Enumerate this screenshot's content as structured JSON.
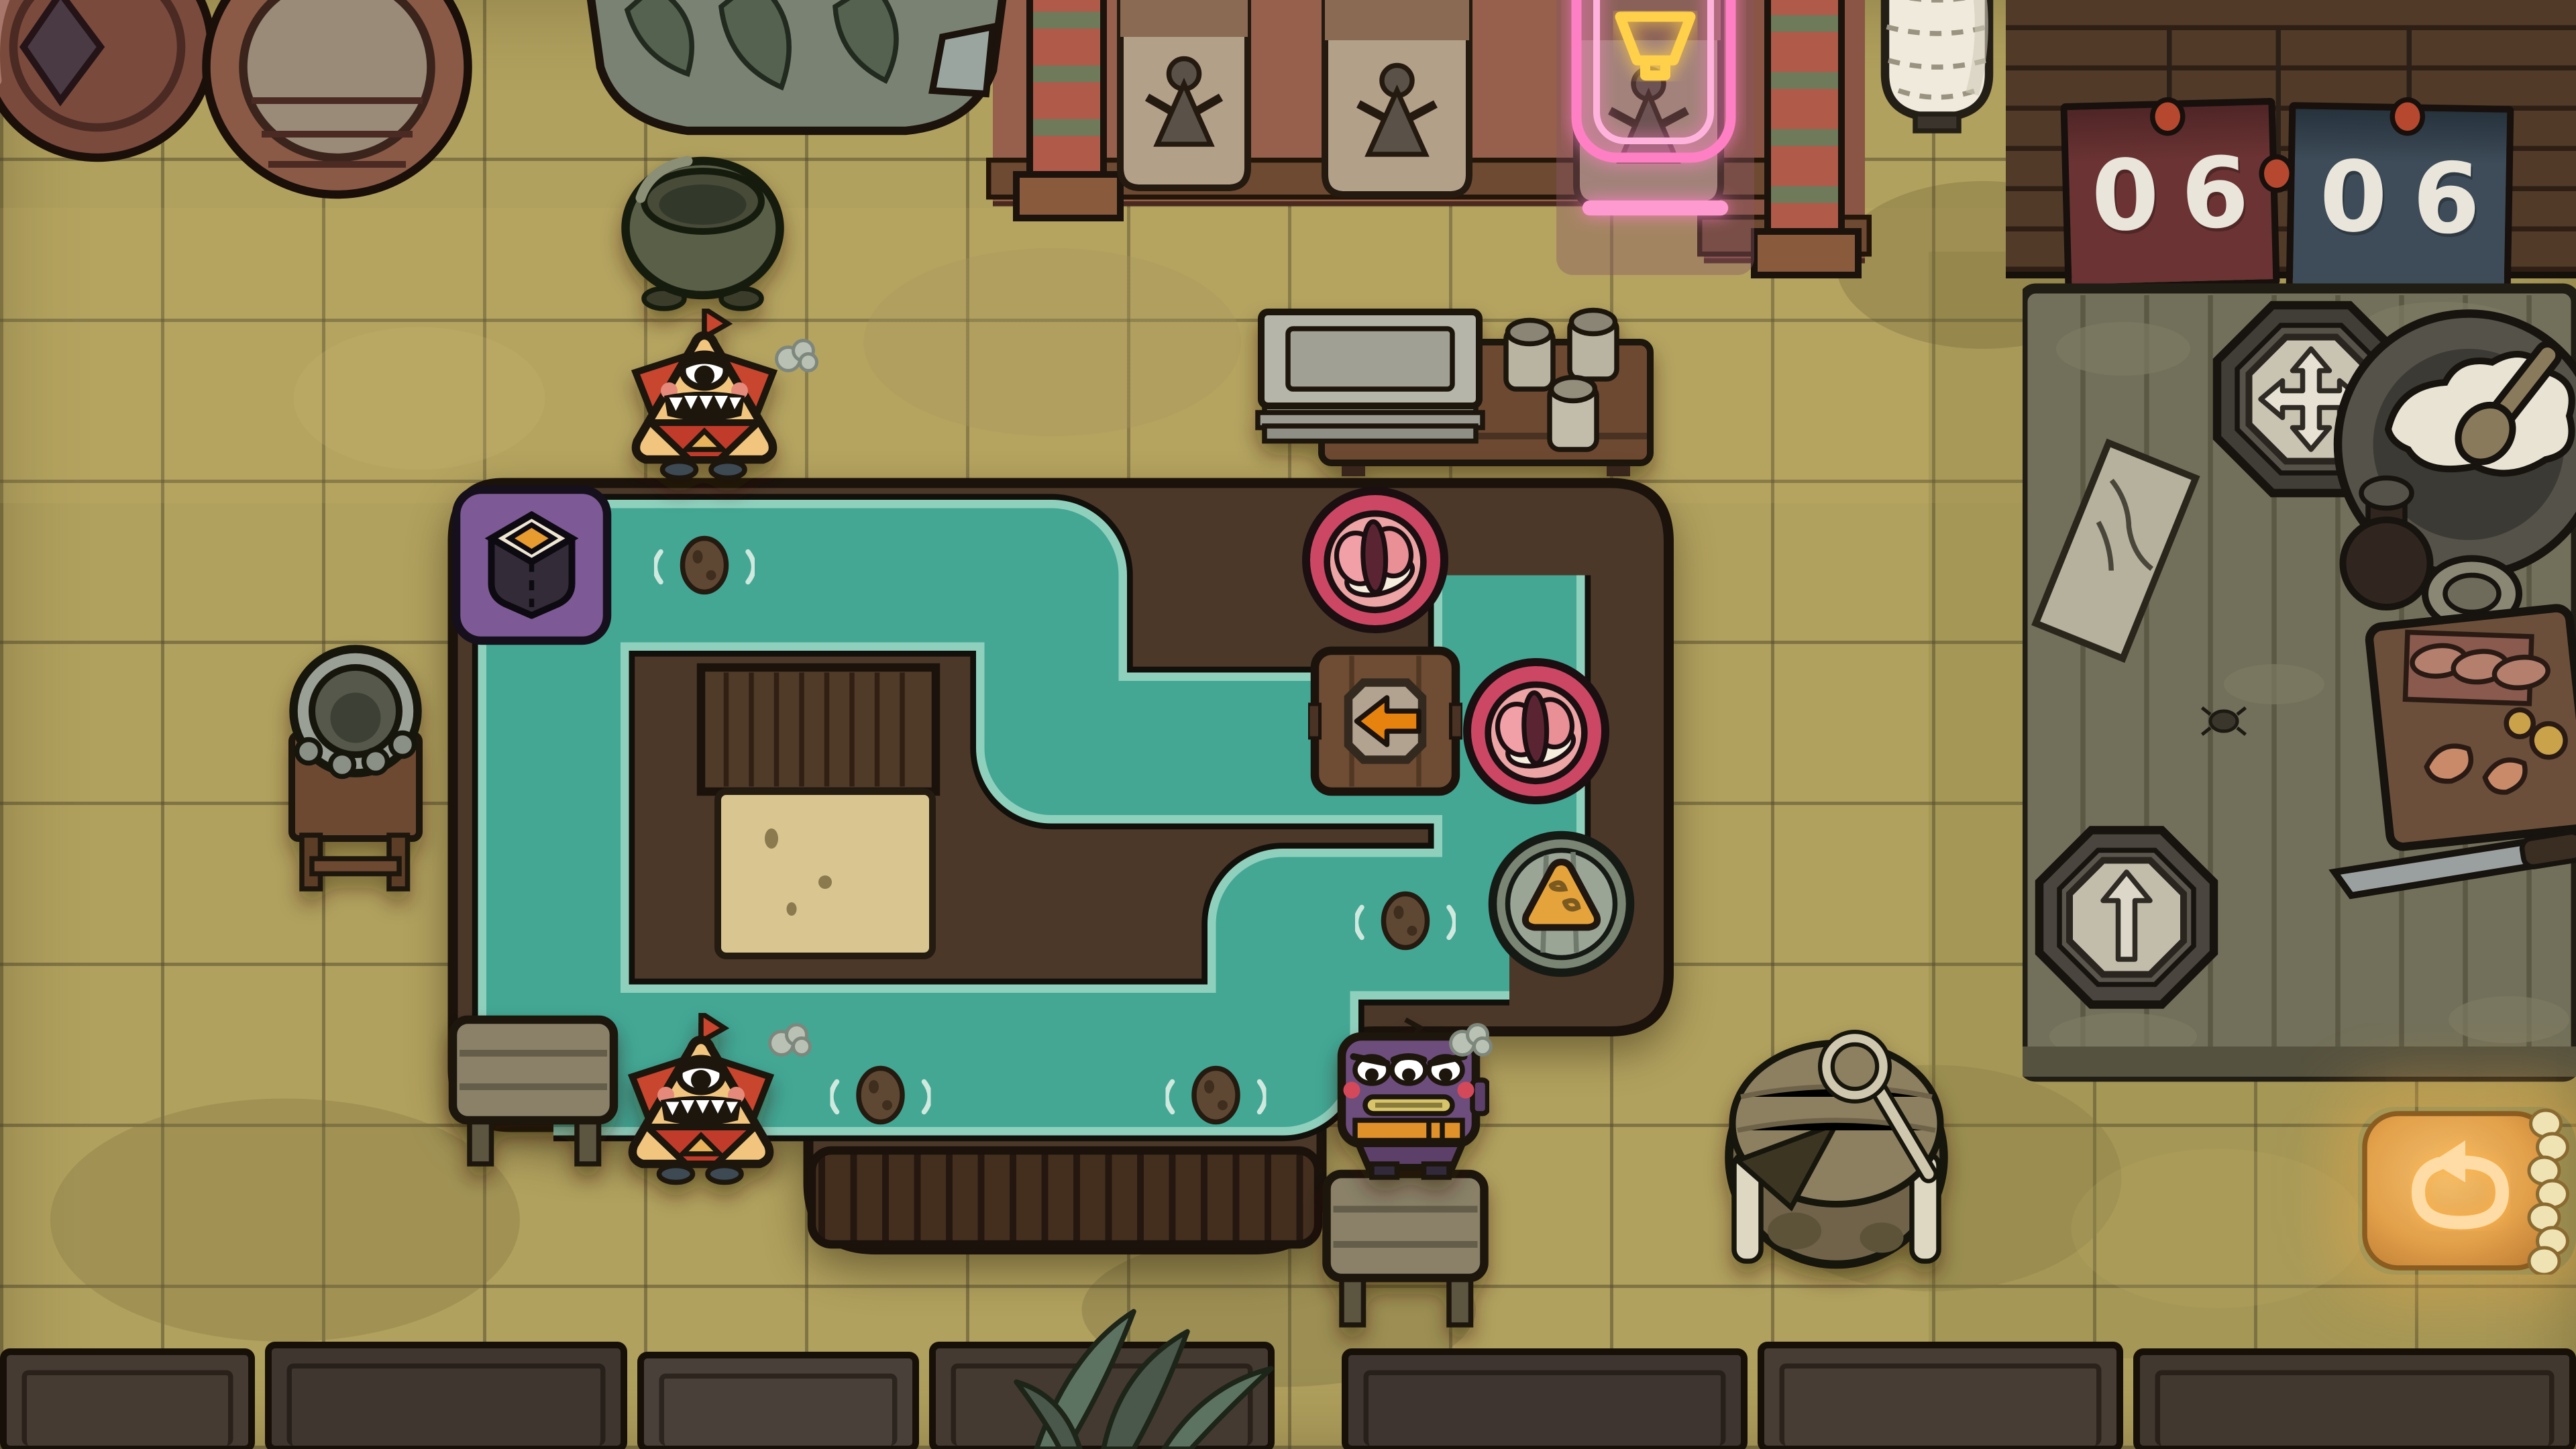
{
  "title": "sushi-bar conveyor puzzle",
  "hud": {
    "scoreboard": {
      "red_panel": {
        "digits": [
          "0",
          "6"
        ],
        "panel_color": "#6b3333"
      },
      "blue_panel": {
        "digits": [
          "0",
          "6"
        ],
        "panel_color": "#3e4c59"
      },
      "pin_color": "#b5482f"
    },
    "undo_button": {
      "icon": "undo-arrow-icon",
      "glow_color": "#f0a94f"
    }
  },
  "toolbox_table": {
    "tokens": [
      {
        "id": "move-token",
        "icon": "move-cross-arrows-icon"
      },
      {
        "id": "up-arrow-token",
        "icon": "arrow-up-icon"
      }
    ],
    "props": [
      "note-paper",
      "rice-bowl-with-paddle",
      "soy-sauce-bottle",
      "sauce-dish",
      "cutting-board-with-fish",
      "kitchen-knife",
      "little-bug"
    ]
  },
  "board": {
    "water_color": "#43a794",
    "frame_color": "#4c3829",
    "dispenser": {
      "icon": "maki-roll-icon",
      "tile_color": "#7d5a96"
    },
    "direction_tile": {
      "icon": "arrow-left-icon",
      "arrow_color": "#e6820e"
    },
    "plates": [
      {
        "id": "plate-1",
        "food": "nigiri-sushi",
        "plate_color": "#cc4763"
      },
      {
        "id": "plate-2",
        "food": "nigiri-sushi",
        "plate_color": "#cc4763"
      },
      {
        "id": "plate-3",
        "food": "fried-tofu-triangle",
        "plate_color": "#7b8573"
      }
    ],
    "floating_stones": 4
  },
  "characters": [
    {
      "id": "triangle-monster-top",
      "mood": "grinning"
    },
    {
      "id": "triangle-monster-bottom",
      "mood": "grinning"
    },
    {
      "id": "robot-customer",
      "mood": "angry"
    }
  ],
  "decor": [
    "barrels",
    "vegetable-sack",
    "wall-banners",
    "neon-bowl-sign",
    "paper-lantern",
    "soup-pot",
    "tray-side-table",
    "stone-mortar-stand",
    "wooden-bench",
    "water-barrel-with-ladle",
    "storage-crates",
    "bamboo-leaves"
  ]
}
